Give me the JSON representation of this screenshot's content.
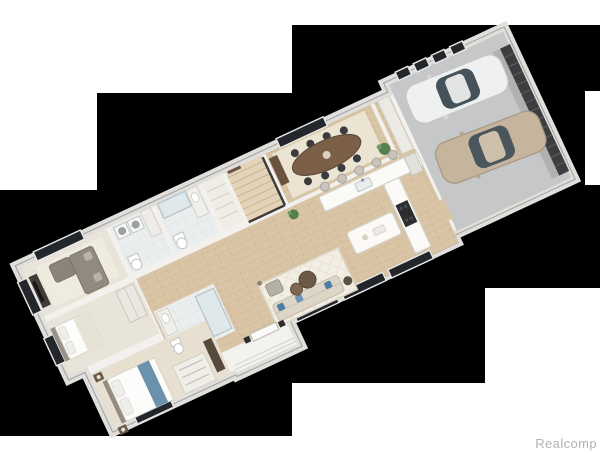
{
  "watermark": {
    "text": "Realcomp",
    "color": "#b3b3b3"
  },
  "palette": {
    "page_background": "#ffffff",
    "mask_black": "#000000",
    "wall_fill": "#f2f1ee",
    "wall_band": "#e0dfdc",
    "wall_edge": "#a9a8a5",
    "wood_floor": "#d9c5a6",
    "wood_line": "#c9b48f",
    "tile_floor": "#ebeeee",
    "carpet_floor": "#e9e4da",
    "master_floor": "#e7dfcf",
    "garage_floor": "#c6c7c9",
    "window_glass": "#23262a",
    "window_frame": "#e8e8e6",
    "dining_table": "#7b5f47",
    "chair_dark": "#3b3a3c",
    "sofa_gray": "#908a81",
    "sofa_cream": "#ddd5c5",
    "pillow_blue": "#4c7da7",
    "round_table_brown": "#6e5948",
    "counter_white": "#fbfaf7",
    "range_dark": "#2c2d2f",
    "car_white": "#eff0f0",
    "car_tan": "#c6b59d",
    "car_glass": "#46525a",
    "garage_door": "#3b3d3f",
    "plant_green": "#54804f",
    "rug_cream": "#f2eee3"
  },
  "masks": [
    {
      "x": 97,
      "y": 93,
      "w": 195,
      "h": 343
    },
    {
      "x": 0,
      "y": 190,
      "w": 97,
      "h": 246
    },
    {
      "x": 292,
      "y": 25,
      "w": 193,
      "h": 358
    },
    {
      "x": 485,
      "y": 25,
      "w": 100,
      "h": 263
    },
    {
      "x": 585,
      "y": 25,
      "w": 15,
      "h": 66
    },
    {
      "x": 585,
      "y": 185,
      "w": 15,
      "h": 103
    }
  ],
  "floor_plan": {
    "type": "3d-isometric-render",
    "rotation_deg": -25,
    "rooms": [
      "family-room",
      "laundry-room",
      "bathroom",
      "hall-closet",
      "staircase",
      "dining-room",
      "kitchen",
      "great-room",
      "foyer",
      "bedroom-2",
      "master-bathroom",
      "walk-in-closet",
      "master-bedroom",
      "entry-porch",
      "garage"
    ],
    "garage": {
      "cars": [
        "white-sedan",
        "tan-sedan"
      ],
      "features": [
        "garage-door",
        "four-windows"
      ]
    },
    "kitchen": {
      "features": [
        "l-shaped-island",
        "sink",
        "five-bar-stools",
        "range"
      ]
    },
    "dining_room": {
      "features": [
        "oval-table",
        "eight-chairs",
        "area-rug",
        "sideboard"
      ]
    },
    "great_room": {
      "features": [
        "lattice-rug",
        "cream-sofa",
        "blue-pillows",
        "two-round-coffee-tables",
        "accent-chair"
      ]
    }
  }
}
